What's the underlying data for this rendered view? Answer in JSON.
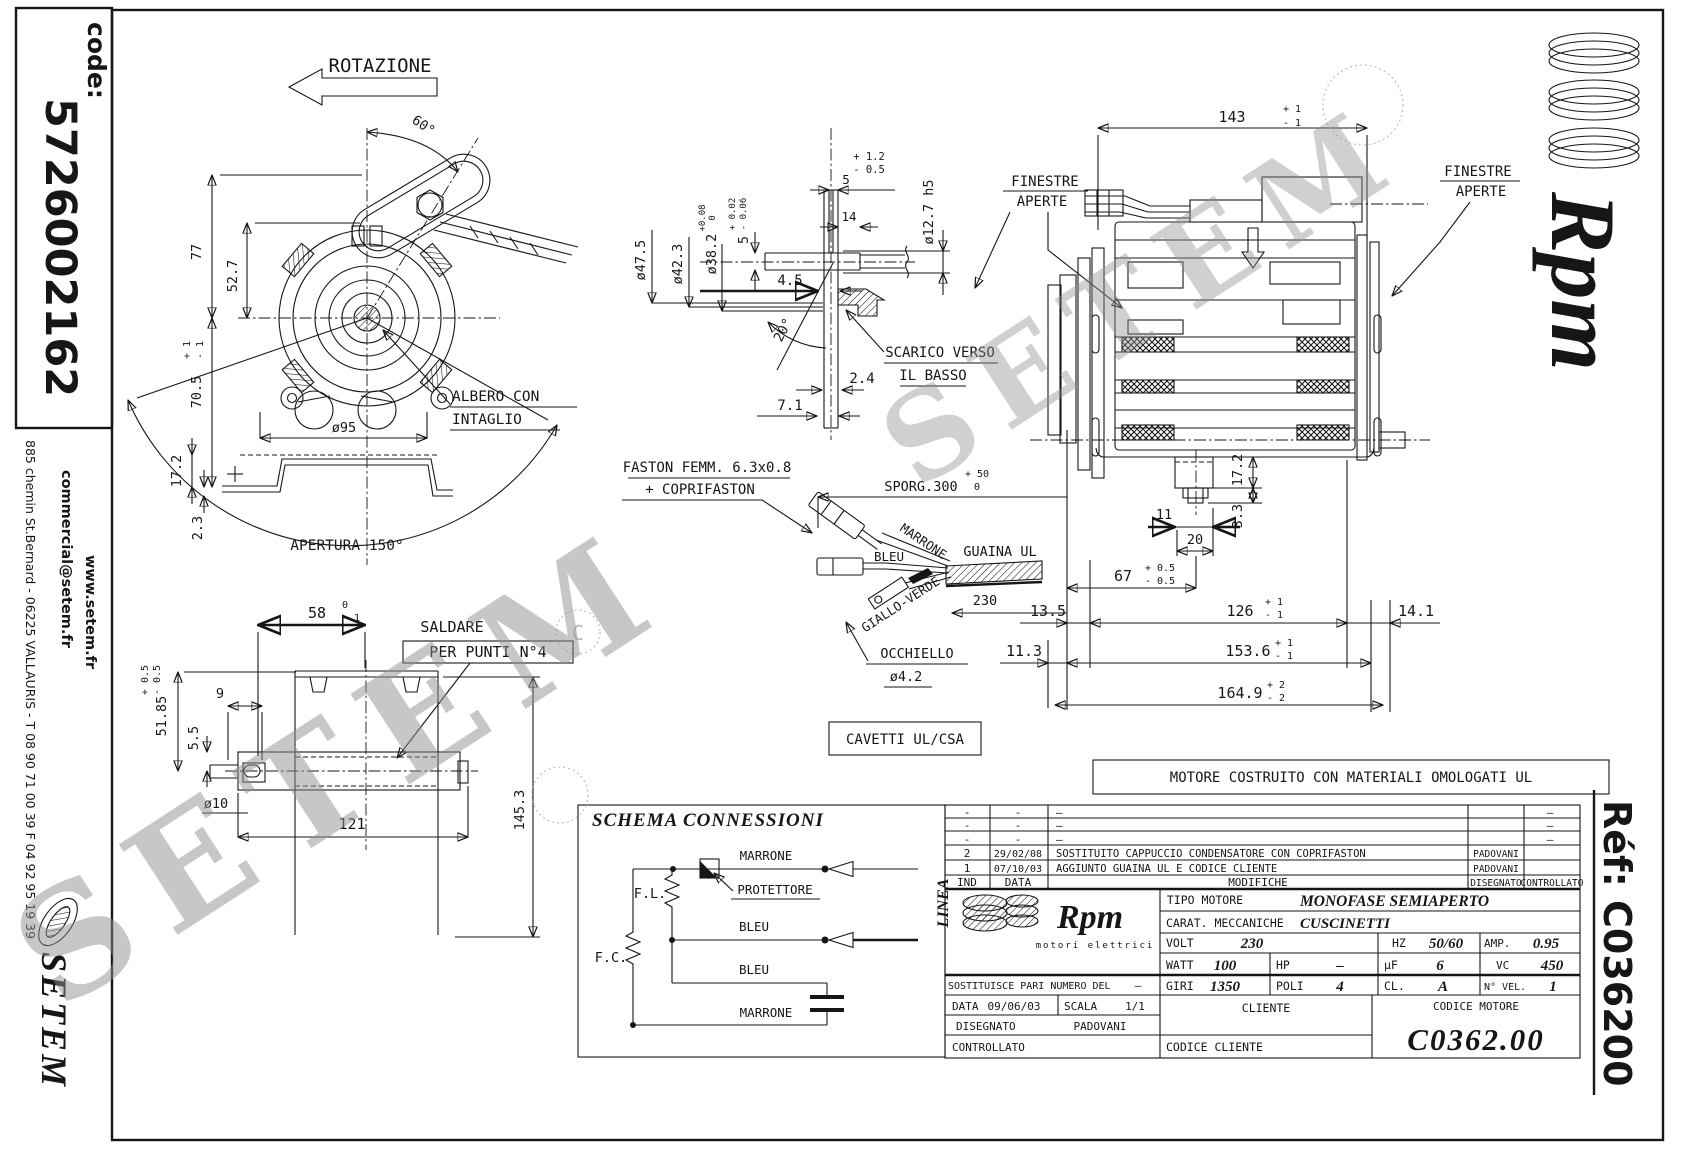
{
  "sheet": {
    "code_label": "code:",
    "code_value": "5726002162",
    "website": "www.setem.fr",
    "email": "commercial@setem.fr",
    "address": "885 chemin St.Bernard  -  06225 VALLAURIS  -  T 08 90 71 00 39   F 04 92 95 19 39",
    "setem_logo": "SETEM",
    "rpm_logo": "Rpm",
    "ref_text": "Réf:  C036200",
    "watermark": "SETEM",
    "copyright_mark": "C"
  },
  "front_view": {
    "rotazione": "ROTAZIONE",
    "angle_60": "60°",
    "dim_77": "77",
    "dim_52_7": "52.7",
    "dim_70_5": "70.5",
    "dim_70_5_tp": "+ 1",
    "dim_70_5_tm": "- 1",
    "dim_17_2": "17.2",
    "dim_2_3": "2.3",
    "dia_95": "ø95",
    "apertura": "APERTURA 150°",
    "albero_1": "ALBERO CON",
    "albero_2": "INTAGLIO"
  },
  "base_view": {
    "dim_58": "58",
    "dim_58_tp": "0",
    "dim_58_tm": "- 1",
    "saldare_1": "SALDARE",
    "saldare_2": "PER PUNTI N°4",
    "dim_51_85": "51.85",
    "dim_51_85_tp": "+ 0.5",
    "dim_51_85_tm": "- 0.5",
    "dim_9": "9",
    "dim_5_5": "5.5",
    "dia_10": "ø10",
    "dim_121": "121",
    "dim_145_3": "145.3"
  },
  "shaft_view": {
    "tol_12_p": "+ 1.2",
    "tol_12_m": "- 0.5",
    "dim_5": "5",
    "dim_14": "14",
    "dia_12_7": "ø12.7 h5",
    "dia_47_5": "ø47.5",
    "dia_42_3": "ø42.3",
    "dia_38_2": "ø38.2",
    "dia_38_2_tp": "+0.08",
    "dia_38_2_tm": "0",
    "dim_5b": "5",
    "dim_5b_tp": "+ 0.02",
    "dim_5b_tm": "- 0.06",
    "dim_4_5": "4.5",
    "angle_20": "20°",
    "scarico_1": "SCARICO VERSO",
    "scarico_2": "IL BASSO",
    "dim_2_4": "2.4",
    "dim_7_1": "7.1"
  },
  "side_view": {
    "dim_143": "143",
    "dim_143_tp": "+ 1",
    "dim_143_tm": "- 1",
    "finestre_l1": "FINESTRE",
    "finestre_l2": "APERTE",
    "finestre_r1": "FINESTRE",
    "finestre_r2": "APERTE",
    "dim_17_2": "17.2",
    "dim_3_3": "3.3",
    "dim_11": "11",
    "dim_20": "20",
    "dim_67": "67",
    "dim_67_tp": "+ 0.5",
    "dim_67_tm": "- 0.5",
    "dim_13_5": "13.5",
    "dim_126": "126",
    "dim_126_tp": "+ 1",
    "dim_126_tm": "- 1",
    "dim_14_1": "14.1",
    "dim_11_3": "11.3",
    "dim_153_6": "153.6",
    "dim_153_6_tp": "+ 1",
    "dim_153_6_tm": "- 1",
    "dim_164_9": "164.9",
    "dim_164_9_tp": "+ 2",
    "dim_164_9_tm": "- 2"
  },
  "cable": {
    "faston_1": "FASTON FEMM. 6.3x0.8",
    "faston_2": "+ COPRIFASTON",
    "sporg": "SPORG.300",
    "sporg_tp": "+ 50",
    "sporg_tm": "0",
    "marrone": "MARRONE",
    "bleu": "BLEU",
    "giallo_verde": "GIALLO-VERDE",
    "guaina": "GUAINA UL",
    "dim_230": "230",
    "occhiello_1": "OCCHIELLO",
    "occhiello_2": "ø4.2"
  },
  "notes": {
    "cavetti": "CAVETTI UL/CSA",
    "omologati": "MOTORE COSTRUITO CON MATERIALI OMOLOGATI UL"
  },
  "schema": {
    "title": "SCHEMA CONNESSIONI",
    "fl": "F.L.",
    "fc": "F.C.",
    "marrone_top": "MARRONE",
    "protettore": "PROTETTORE",
    "bleu_mid": "BLEU",
    "bleu_low": "BLEU",
    "marrone_bot": "MARRONE",
    "linea": "LINEA"
  },
  "titleblock": {
    "rev": [
      {
        "ind": "-",
        "date": "-",
        "desc": "–",
        "dis": "",
        "ctrl": "–"
      },
      {
        "ind": "-",
        "date": "-",
        "desc": "–",
        "dis": "",
        "ctrl": "–"
      },
      {
        "ind": "-",
        "date": "-",
        "desc": "–",
        "dis": "",
        "ctrl": "–"
      },
      {
        "ind": "2",
        "date": "29/02/08",
        "desc": "SOSTITUITO CAPPUCCIO CONDENSATORE CON COPRIFASTON",
        "dis": "PADOVANI",
        "ctrl": ""
      },
      {
        "ind": "1",
        "date": "07/10/03",
        "desc": "AGGIUNTO GUAINA UL E CODICE CLIENTE",
        "dis": "PADOVANI",
        "ctrl": ""
      }
    ],
    "hdr_ind": "IND",
    "hdr_date": "DATA",
    "hdr_mod": "MODIFICHE",
    "hdr_dis": "DISEGNATO",
    "hdr_ctrl": "CONTROLLATO",
    "logo_text": "Rpm",
    "logo_sub": "motori elettrici",
    "tipo_label": "TIPO MOTORE",
    "tipo_value": "MONOFASE SEMIAPERTO",
    "carat_label": "CARAT. MECCANICHE",
    "carat_value": "CUSCINETTI",
    "volt_label": "VOLT",
    "volt_value": "230",
    "hz_label": "HZ",
    "hz_value": "50/60",
    "amp_label": "AMP.",
    "amp_value": "0.95",
    "watt_label": "WATT",
    "watt_value": "100",
    "hp_label": "HP",
    "hp_value": "–",
    "uf_label": "µF",
    "uf_value": "6",
    "vc_label": "VC",
    "vc_value": "450",
    "sost_label": "SOSTITUISCE PARI NUMERO DEL",
    "sost_value": "–",
    "giri_label": "GIRI",
    "giri_value": "1350",
    "poli_label": "POLI",
    "poli_value": "4",
    "cl_label": "CL.",
    "cl_value": "A",
    "nvel_label": "N° VEL.",
    "nvel_value": "1",
    "date_label": "DATA",
    "date_value": "09/06/03",
    "scala_label": "SCALA",
    "scala_value": "1/1",
    "cliente_label": "CLIENTE",
    "cod_mot_label": "CODICE MOTORE",
    "cod_mot_value": "C0362.00",
    "dis_label": "DISEGNATO",
    "dis_value": "PADOVANI",
    "ctrl_label": "CONTROLLATO",
    "cod_cli_label": "CODICE CLIENTE"
  }
}
